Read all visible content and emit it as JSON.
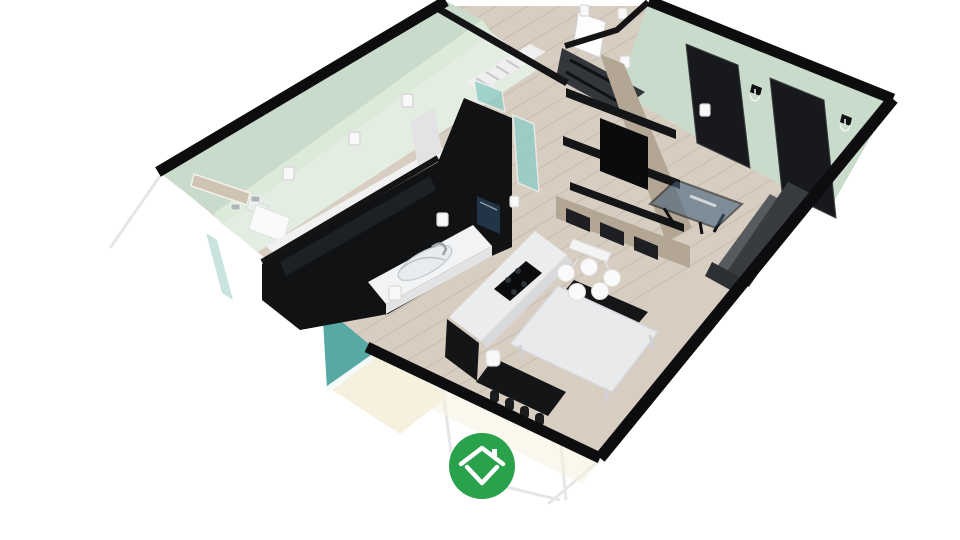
{
  "app": {
    "name": "Floorplanner 3D dollhouse view",
    "logo_label": "Floorplanner logo"
  },
  "scene": {
    "description": "Isometric cutaway 3D render of an apartment: bathroom, hallway with stairs, closet shelving, kitchen with island, dining set and living room; lower level partially visible below the cutaway walls",
    "rooms": [
      {
        "id": "bathroom",
        "label": "bathroom"
      },
      {
        "id": "hallway",
        "label": "hallway with stairs"
      },
      {
        "id": "closet",
        "label": "closet"
      },
      {
        "id": "kitchen",
        "label": "kitchen"
      },
      {
        "id": "dining",
        "label": "dining area"
      },
      {
        "id": "living",
        "label": "living room"
      }
    ],
    "objects": [
      "wall lamps",
      "vanity panel",
      "toilet",
      "stairs",
      "interior white door",
      "shelving unit with TV",
      "black interior doors",
      "candle wall sconces",
      "kitchen counter with sink",
      "tall cabinet with screen",
      "kitchen island with cooktop",
      "dining table",
      "black benches",
      "globe pendant lamp",
      "glass coffee table",
      "gray sofa",
      "teal glass windows",
      "teal accent wall",
      "green logo badge"
    ],
    "colors": {
      "background": "#ffffff",
      "wall_top": "#0d0d0f",
      "interior_wall_line": "#141417",
      "mint_wall": "#c9dccb",
      "mint_wall_light": "#dcead9",
      "mint_floor": "#e4ede1",
      "wood_floor": "#d7cdc0",
      "plank_line": "#c3b8a9",
      "kitchen_black": "#101214",
      "gloss_highlight": "#2a2e33",
      "counter_white": "#f2f3f4",
      "island_top": "#ebecee",
      "furniture_black": "#141517",
      "shelf_wood": "#b3a695",
      "closet_dark": "#33363a",
      "tv_black": "#0a0b0d",
      "door_dark": "#17191c",
      "sofa_dark": "#383c40",
      "sofa_seat": "#575b5f",
      "table_white": "#e9eaec",
      "glass_blue": "#46647f",
      "glass_teal": "#8fccc6",
      "teal_accent": "#57a9a4",
      "teal_glass_light": "#c9e4df",
      "lower_floor_cream": "#f6f1df",
      "lamp_white": "#f8f8f8",
      "lamp_stroke": "#d9d9d9",
      "stair_white": "#efefef",
      "exterior_line": "#e6e6e8",
      "screen_glow": "#223447",
      "logo_green": "#2aa24b",
      "logo_white": "#ffffff"
    }
  }
}
